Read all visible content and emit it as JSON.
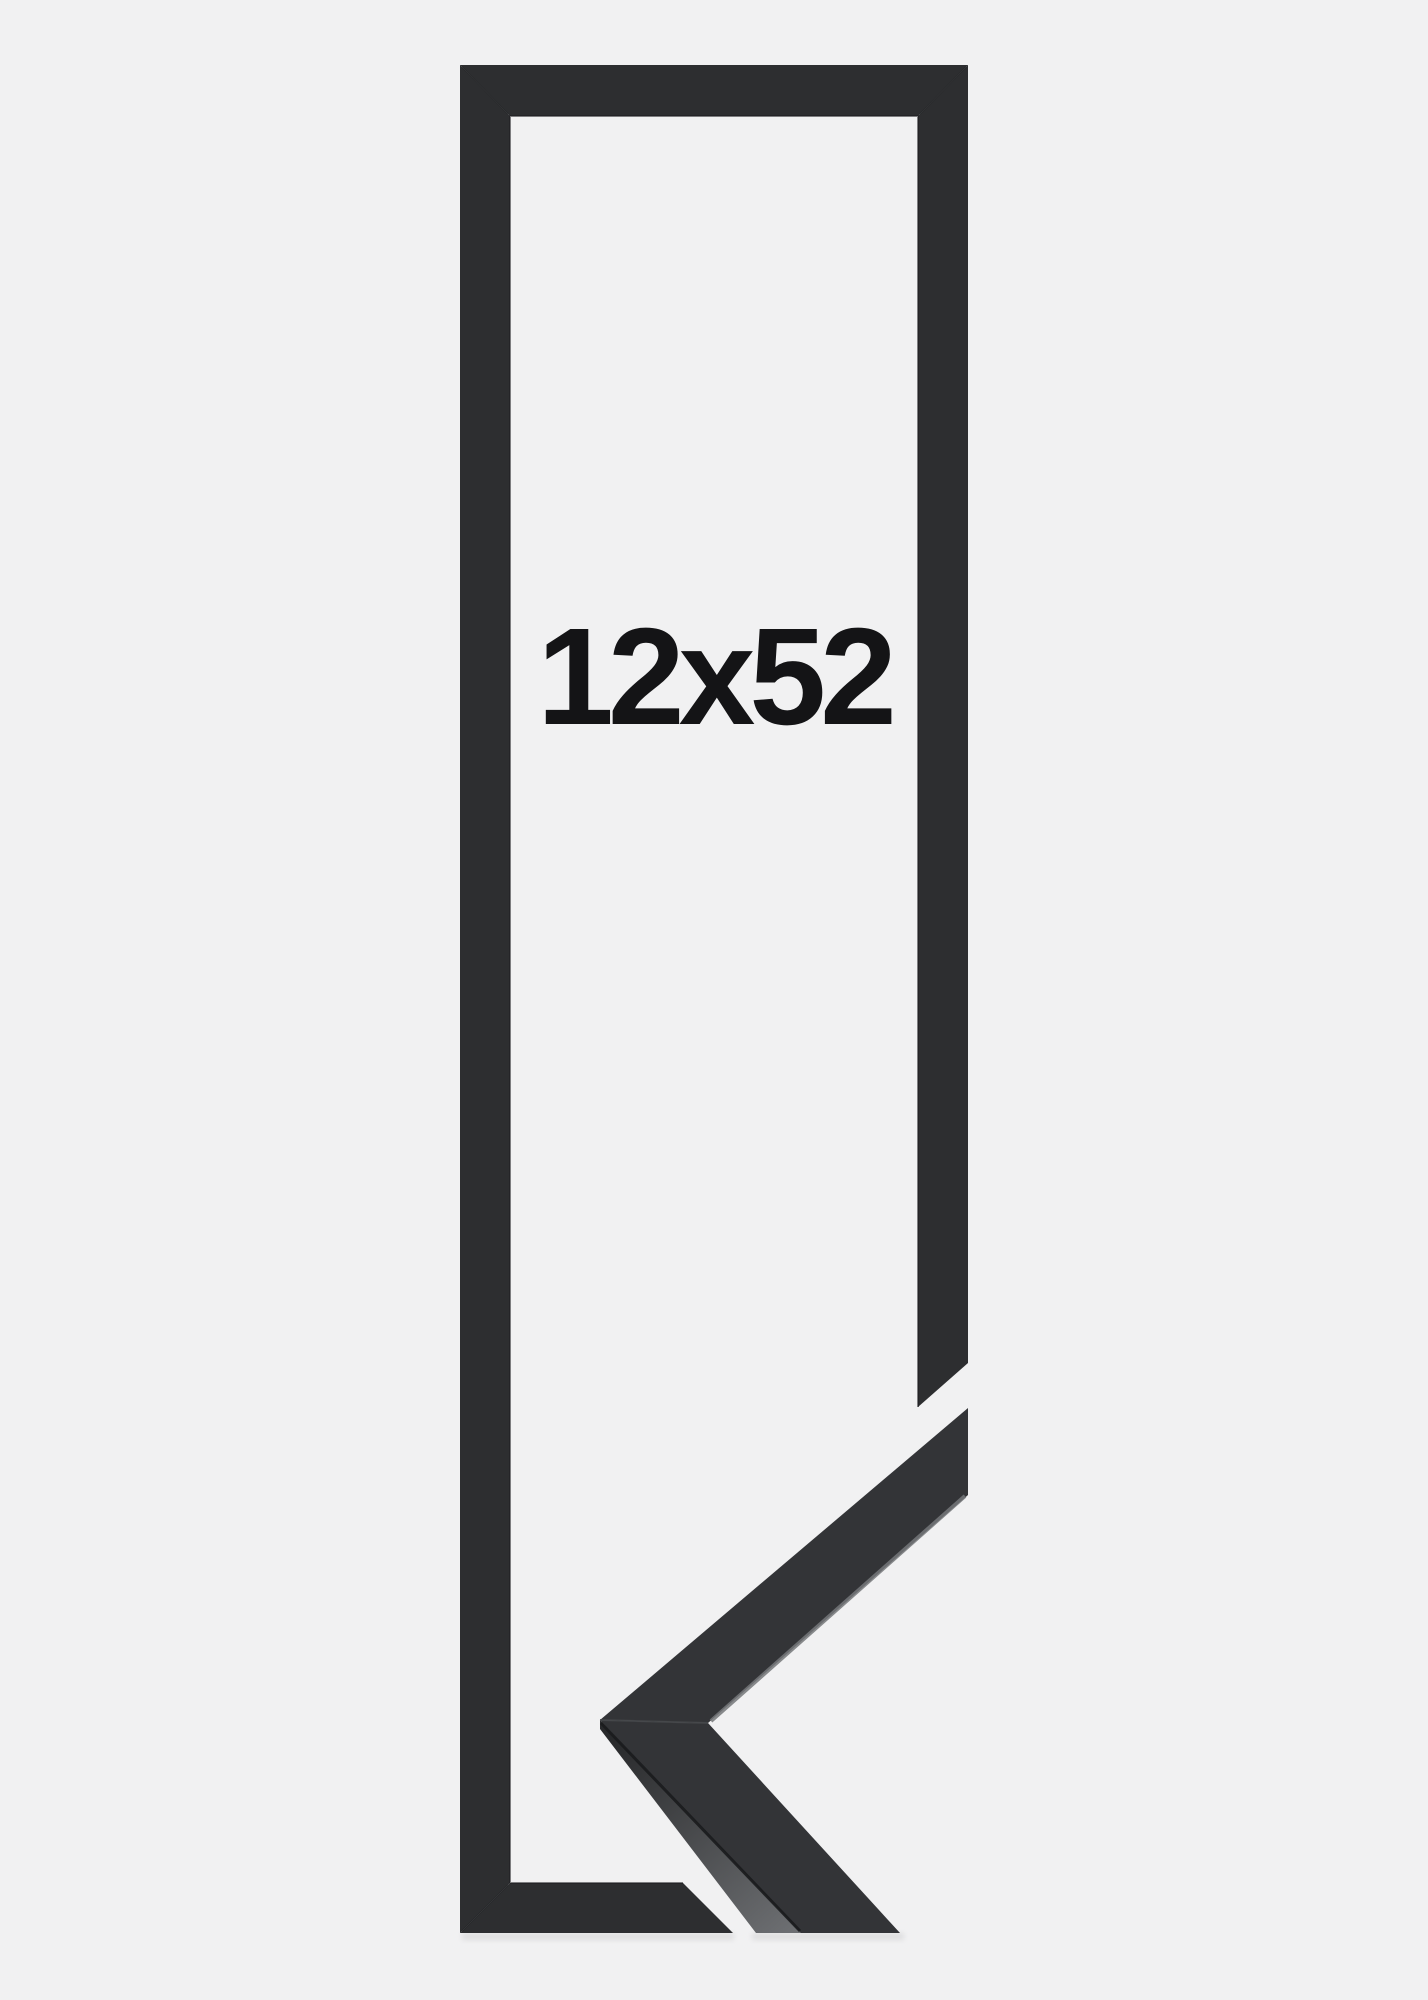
{
  "product": {
    "size_label": "12x52",
    "description": "black picture frame mockup with corner sample"
  },
  "colors": {
    "background": "#f1f1f2",
    "frame": "#2d2e30",
    "frame_inner_edge": "#1d1e20",
    "frame_seam": "#1f2022",
    "sample_face": "#333437",
    "sample_side_dark": "#28292b",
    "sample_side_light": "#6d6f72",
    "edge_highlight": "#75777a",
    "edge_shadow": "#1a1b1d",
    "sample_seam": "#46484b",
    "label_text": "#141416",
    "shadow": "#000000"
  }
}
